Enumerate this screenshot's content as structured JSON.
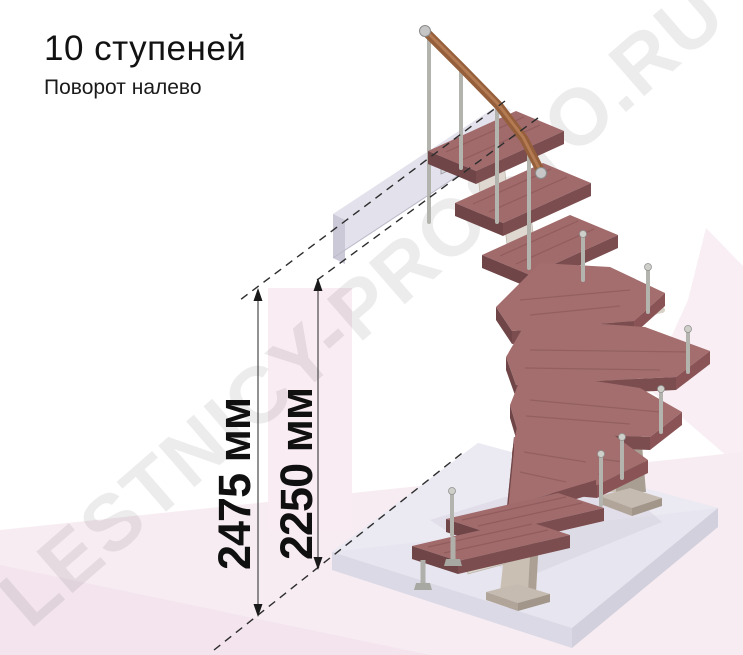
{
  "title": {
    "main": "10 ступеней",
    "subtitle": "Поворот налево"
  },
  "dimensions": [
    {
      "id": "floor-to-floor-height",
      "label": "2475 мм"
    },
    {
      "id": "height-to-top-step",
      "label": "2250 мм"
    }
  ],
  "watermark": {
    "text": "LESTNICY-PROSTO.RU"
  },
  "figure": {
    "type": "3d-render-modular-staircase",
    "steps_total": 10,
    "turn_direction": "left",
    "lower_straight_steps": 2,
    "winder_steps": 5,
    "upper_straight_steps": 3,
    "has_handrail": true,
    "has_upper_floor_slab": true,
    "has_floor_platform": true
  },
  "colors": {
    "tread_top": "#a16a6b",
    "tread_front": "#7c4d4f",
    "handrail_wood": "#955f3c",
    "metal_baluster": "#b4b4af",
    "column_beige": "#ccc2b6",
    "floor_slab": "#e6e4ee",
    "background_pink": "#f7ecf2",
    "text": "#121212"
  }
}
